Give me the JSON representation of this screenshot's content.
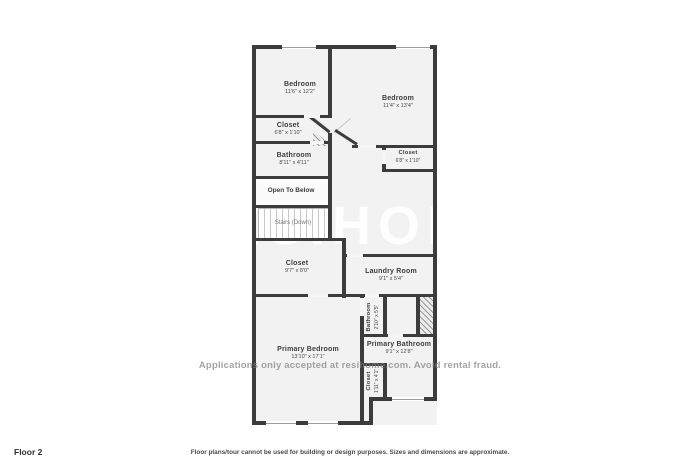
{
  "plan": {
    "wall_color": "#3c3c3c",
    "room_fill": "#f2f2f2",
    "rooms": {
      "bedroom_left": {
        "name": "Bedroom",
        "dims": "11'6\" x 12'2\""
      },
      "bedroom_right": {
        "name": "Bedroom",
        "dims": "11'4\" x 13'4\""
      },
      "closet_upper_left": {
        "name": "Closet",
        "dims": "6'8\" x 1'10\""
      },
      "bathroom_upper": {
        "name": "Bathroom",
        "dims": "8'11\" x 4'11\""
      },
      "open_to_below": {
        "name": "Open To Below"
      },
      "stairs": {
        "name": "Stairs (Down)"
      },
      "closet_middle": {
        "name": "Closet",
        "dims": "9'7\" x 8'0\""
      },
      "closet_upper_right": {
        "name": "Closet",
        "dims": "6'8\" x 1'10\""
      },
      "laundry_room": {
        "name": "Laundry Room",
        "dims": "9'1\" x 5'4\""
      },
      "bathroom_small": {
        "name": "Bathroom",
        "dims": "2'10\" x 5'5\""
      },
      "primary_bedroom": {
        "name": "Primary Bedroom",
        "dims": "13'10\" x 17'1\""
      },
      "primary_bathroom": {
        "name": "Primary Bathroom",
        "dims": "9'1\" x 12'8\""
      },
      "closet_primary": {
        "name": "Closet",
        "dims": "1'11\" x 4'1\""
      }
    }
  },
  "watermarks": {
    "big_text": "RESIHOME",
    "small_text": "Applications only accepted at resihome.com. Avoid rental fraud."
  },
  "footer": {
    "floor_label": "Floor 2",
    "disclaimer": "Floor plans/tour cannot be used for building or design purposes. Sizes and dimensions are approximate."
  }
}
